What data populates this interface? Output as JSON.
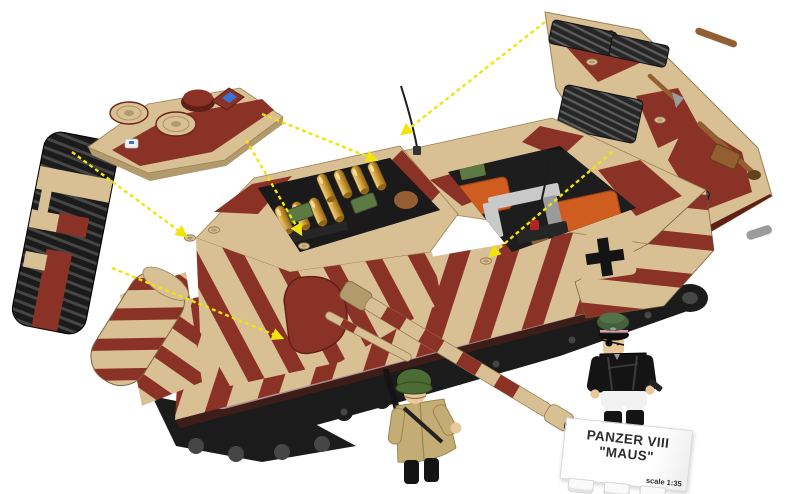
{
  "label_plate": {
    "title_line1": "PANZER VIII",
    "title_line2": "\"MAUS\"",
    "scale_text": "scale 1:35"
  },
  "scene": {
    "type": "product-photo",
    "subject": "Brick-construction Panzer VIII Maus tank model in red-brown and tan winter camouflage, shown in exploded view",
    "detached_parts": [
      "track-side-skirt-panel",
      "turret-roof-panel-with-hatches",
      "engine-deck-panel-with-grilles"
    ],
    "open_compartments": [
      "turret-ammo-bay-with-gold-shells",
      "engine-bay-with-orange-engine",
      "front-hull-suspension-bay"
    ],
    "figures": [
      {
        "name": "soldier-minifigure",
        "look": "green helmet, khaki greatcoat, slung rifle"
      },
      {
        "name": "officer-minifigure",
        "look": "green peaked cap with pink band, eyepatch, black panzer jacket, white trousers, pistol"
      }
    ],
    "markings": [
      "german-balkenkreuz-cross"
    ],
    "callouts": {
      "style": "yellow dashed assembly arrows",
      "count": 6
    }
  },
  "theme": {
    "white": "#ffffff",
    "offWhite": "#f2f2f2",
    "black": "#141414",
    "tan": "#d8bf94",
    "tanDark": "#b29a6c",
    "tanLight": "#e9d8b4",
    "maroon": "#8a3226",
    "maroonDark": "#5f1f15",
    "trackBlack": "#1b1b1b",
    "trackSlat": "#464646",
    "steel": "#8f8f8f",
    "lightGrey": "#c9c9c9",
    "midGrey": "#9b9b9b",
    "orange": "#cf5d20",
    "orangeDark": "#a84416",
    "olive": "#5d7a45",
    "gold": "#c9962f",
    "goldLight": "#f0d48a",
    "goldDeep": "#8f6418",
    "brown": "#935f32",
    "brownDark": "#64411f",
    "yellow": "#f2e40a",
    "blue": "#3a72d8",
    "red": "#b02424",
    "faceTan": "#e9c89c",
    "coatKhaki": "#c3ad74",
    "coatKhakiDark": "#99854f",
    "helmetGreen": "#4c6b35",
    "capGreen": "#44603a",
    "capPink": "#e59ab8",
    "signText": "#2d2d30",
    "signBorder": "#d8d8d8"
  }
}
